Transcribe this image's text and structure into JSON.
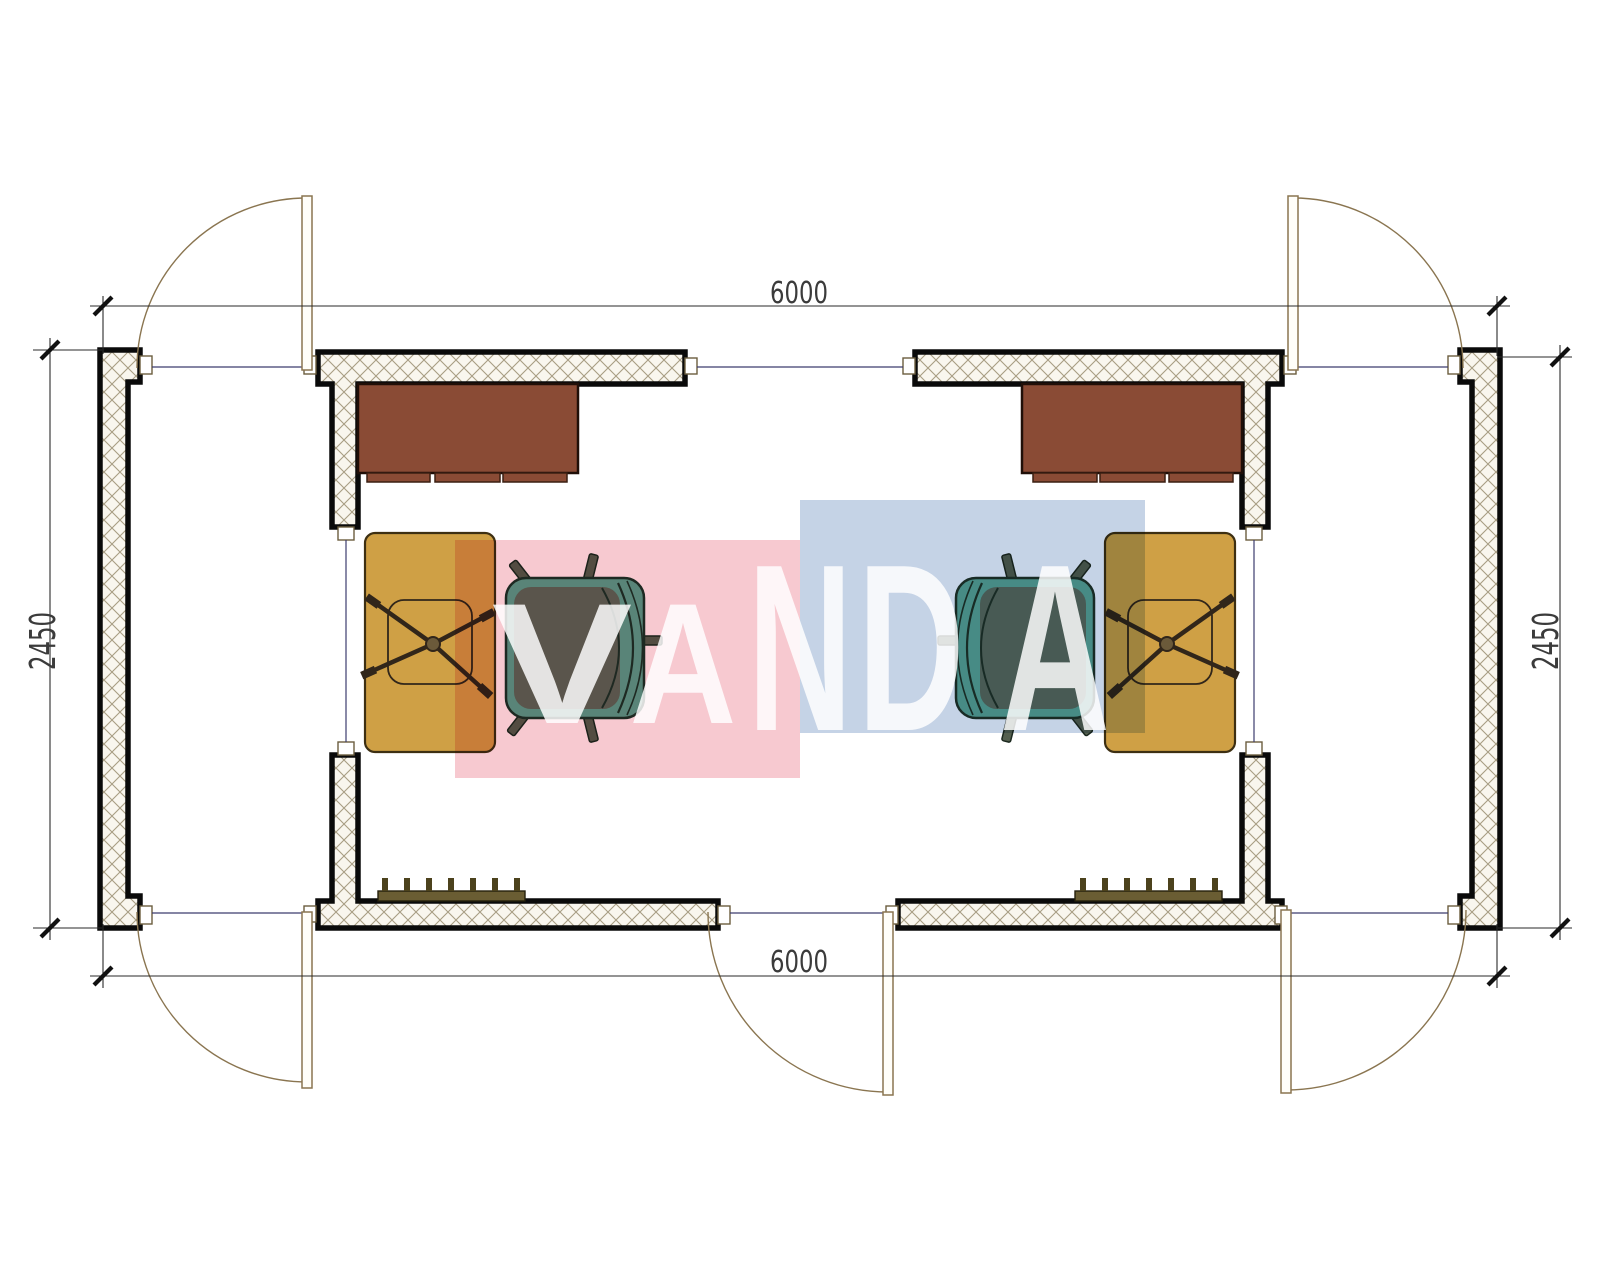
{
  "drawing": {
    "type": "floor-plan",
    "dimensions": {
      "top": "6000",
      "bottom": "6000",
      "left": "2450",
      "right": "2450"
    },
    "watermark": {
      "letters": [
        "V",
        "A",
        "N",
        "D",
        "A"
      ],
      "pink_block": "#f7c9d0",
      "blue_block": "#c5d3e6"
    },
    "colors": {
      "wall_outline": "#0a0a0a",
      "hatch_line": "#a89d83",
      "hatch_bg": "#f9f6ee",
      "desk": "#8a4b35",
      "desk_edge": "#200f08",
      "table": "#cfa045",
      "table_edge": "#3d2f12",
      "chair_seat": "#5ca893",
      "chair_cushion": "#5d685a",
      "chair_edge": "#1f3329",
      "xchair_line": "#31261a",
      "xchair_hub": "#6b5a3a",
      "radiator": "#6a5d33",
      "radiator_teeth": "#4c421d",
      "door": "#8a7550",
      "door_fill": "#fffef9",
      "dim_line": "#2a2a2a",
      "dim_text": "#3b3b3b",
      "tick": "#111111",
      "threshold": "#3c3c6e",
      "cap_stroke": "#6b5d3f"
    }
  }
}
